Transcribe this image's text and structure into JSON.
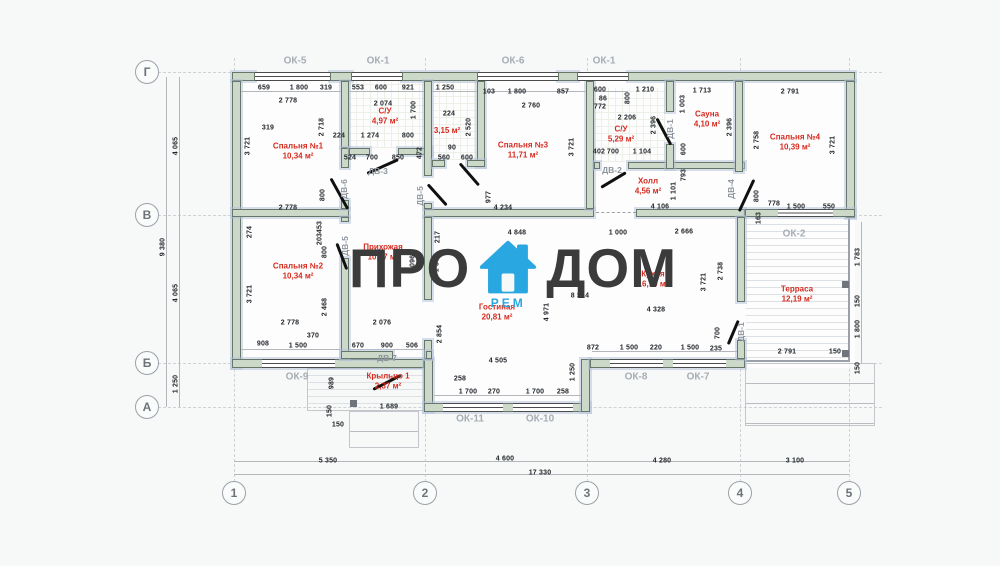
{
  "watermark": {
    "left": "ПРО",
    "right": "ДОМ",
    "badge": "РЕМ",
    "icon": "house-icon",
    "icon_color": "#29a7e0",
    "text_color": "#3b3b3b"
  },
  "axes": {
    "bottom": [
      {
        "label": "1",
        "x": 234
      },
      {
        "label": "2",
        "x": 425
      },
      {
        "label": "3",
        "x": 587
      },
      {
        "label": "4",
        "x": 740
      },
      {
        "label": "5",
        "x": 849
      }
    ],
    "left": [
      {
        "label": "Г",
        "y": 72
      },
      {
        "label": "В",
        "y": 215
      },
      {
        "label": "Б",
        "y": 363
      },
      {
        "label": "А",
        "y": 407
      }
    ]
  },
  "rooms": [
    {
      "name": "Спальня №1",
      "area": "10,34 м²",
      "x": 298,
      "y": 152
    },
    {
      "name": "С/У",
      "area": "4,97 м²",
      "x": 385,
      "y": 117
    },
    {
      "name": "",
      "area": "3,15 м²",
      "x": 447,
      "y": 131
    },
    {
      "name": "Спальня №3",
      "area": "11,71 м²",
      "x": 523,
      "y": 151
    },
    {
      "name": "С/У",
      "area": "5,29 м²",
      "x": 621,
      "y": 135
    },
    {
      "name": "Сауна",
      "area": "4,10 м²",
      "x": 707,
      "y": 120
    },
    {
      "name": "Спальня №4",
      "area": "10,39 м²",
      "x": 795,
      "y": 143
    },
    {
      "name": "Холл",
      "area": "4,56 м²",
      "x": 648,
      "y": 187
    },
    {
      "name": "Спальня №2",
      "area": "10,34 м²",
      "x": 298,
      "y": 272
    },
    {
      "name": "Прихожая",
      "area": "10,57 м²",
      "x": 383,
      "y": 253
    },
    {
      "name": "Гостиная",
      "area": "20,81 м²",
      "x": 497,
      "y": 313
    },
    {
      "name": "Кухня",
      "area": "16,10 м²",
      "x": 653,
      "y": 280
    },
    {
      "name": "Терраса",
      "area": "12,19 м²",
      "x": 797,
      "y": 295
    },
    {
      "name": "Крыльцо 1",
      "area": "2,37 м²",
      "x": 388,
      "y": 382
    }
  ],
  "window_labels": [
    {
      "label": "ОК-5",
      "x": 295,
      "y": 61
    },
    {
      "label": "ОК-1",
      "x": 378,
      "y": 61
    },
    {
      "label": "ОК-6",
      "x": 513,
      "y": 61
    },
    {
      "label": "ОК-1",
      "x": 604,
      "y": 61
    },
    {
      "label": "ОК-2",
      "x": 794,
      "y": 234
    },
    {
      "label": "ОК-9",
      "x": 297,
      "y": 377
    },
    {
      "label": "ОК-11",
      "x": 470,
      "y": 419
    },
    {
      "label": "ОК-10",
      "x": 540,
      "y": 419
    },
    {
      "label": "ОК-8",
      "x": 636,
      "y": 377
    },
    {
      "label": "ОК-7",
      "x": 698,
      "y": 377
    }
  ],
  "door_labels": [
    {
      "label": "ДВ-3",
      "x": 378,
      "y": 171
    },
    {
      "label": "ДВ-6",
      "x": 344,
      "y": 189,
      "v": 1
    },
    {
      "label": "ДВ-5",
      "x": 420,
      "y": 196,
      "v": 1
    },
    {
      "label": "ДВ-2",
      "x": 612,
      "y": 170
    },
    {
      "label": "ДВ-1",
      "x": 670,
      "y": 129,
      "v": 1
    },
    {
      "label": "ДВ-4",
      "x": 731,
      "y": 189,
      "v": 1
    },
    {
      "label": "ДВ-5",
      "x": 345,
      "y": 246,
      "v": 1
    },
    {
      "label": "ДВ-7",
      "x": 387,
      "y": 358
    },
    {
      "label": "ДВ-1",
      "x": 741,
      "y": 332,
      "v": 1
    }
  ],
  "dims": [
    {
      "t": "659",
      "x": 264,
      "y": 88
    },
    {
      "t": "1 800",
      "x": 299,
      "y": 88
    },
    {
      "t": "319",
      "x": 326,
      "y": 88
    },
    {
      "t": "2 778",
      "x": 288,
      "y": 101
    },
    {
      "t": "319",
      "x": 268,
      "y": 128
    },
    {
      "t": "224",
      "x": 339,
      "y": 136
    },
    {
      "t": "1 274",
      "x": 370,
      "y": 136
    },
    {
      "t": "800",
      "x": 408,
      "y": 136
    },
    {
      "t": "524",
      "x": 350,
      "y": 158
    },
    {
      "t": "700",
      "x": 372,
      "y": 158
    },
    {
      "t": "850",
      "x": 398,
      "y": 158
    },
    {
      "t": "553",
      "x": 358,
      "y": 88
    },
    {
      "t": "600",
      "x": 381,
      "y": 88
    },
    {
      "t": "921",
      "x": 408,
      "y": 88
    },
    {
      "t": "2 074",
      "x": 383,
      "y": 104
    },
    {
      "t": "1 250",
      "x": 445,
      "y": 88
    },
    {
      "t": "224",
      "x": 449,
      "y": 114
    },
    {
      "t": "90",
      "x": 452,
      "y": 148
    },
    {
      "t": "560",
      "x": 444,
      "y": 158
    },
    {
      "t": "600",
      "x": 467,
      "y": 158
    },
    {
      "t": "103",
      "x": 489,
      "y": 92
    },
    {
      "t": "1 800",
      "x": 517,
      "y": 92
    },
    {
      "t": "857",
      "x": 563,
      "y": 92
    },
    {
      "t": "2 760",
      "x": 531,
      "y": 106
    },
    {
      "t": "600",
      "x": 600,
      "y": 90
    },
    {
      "t": "86",
      "x": 603,
      "y": 99
    },
    {
      "t": "772",
      "x": 600,
      "y": 107
    },
    {
      "t": "1 210",
      "x": 645,
      "y": 90
    },
    {
      "t": "2 206",
      "x": 627,
      "y": 118
    },
    {
      "t": "402",
      "x": 599,
      "y": 152
    },
    {
      "t": "700",
      "x": 613,
      "y": 152
    },
    {
      "t": "1 104",
      "x": 642,
      "y": 152
    },
    {
      "t": "1 713",
      "x": 702,
      "y": 91
    },
    {
      "t": "2 791",
      "x": 790,
      "y": 92
    },
    {
      "t": "2 778",
      "x": 288,
      "y": 208
    },
    {
      "t": "4 234",
      "x": 503,
      "y": 208
    },
    {
      "t": "4 106",
      "x": 660,
      "y": 207
    },
    {
      "t": "778",
      "x": 774,
      "y": 204
    },
    {
      "t": "1 500",
      "x": 796,
      "y": 207
    },
    {
      "t": "550",
      "x": 829,
      "y": 207
    },
    {
      "t": "4 848",
      "x": 517,
      "y": 233
    },
    {
      "t": "1 000",
      "x": 618,
      "y": 233
    },
    {
      "t": "2 666",
      "x": 684,
      "y": 232
    },
    {
      "t": "8 514",
      "x": 580,
      "y": 296
    },
    {
      "t": "4 328",
      "x": 656,
      "y": 310
    },
    {
      "t": "2 778",
      "x": 290,
      "y": 323
    },
    {
      "t": "2 076",
      "x": 382,
      "y": 323
    },
    {
      "t": "370",
      "x": 313,
      "y": 336
    },
    {
      "t": "908",
      "x": 263,
      "y": 344
    },
    {
      "t": "1 500",
      "x": 298,
      "y": 346
    },
    {
      "t": "670",
      "x": 358,
      "y": 346
    },
    {
      "t": "900",
      "x": 387,
      "y": 346
    },
    {
      "t": "506",
      "x": 412,
      "y": 346
    },
    {
      "t": "872",
      "x": 593,
      "y": 348
    },
    {
      "t": "1 500",
      "x": 629,
      "y": 348
    },
    {
      "t": "220",
      "x": 656,
      "y": 348
    },
    {
      "t": "1 500",
      "x": 690,
      "y": 348
    },
    {
      "t": "235",
      "x": 716,
      "y": 349
    },
    {
      "t": "2 791",
      "x": 787,
      "y": 352
    },
    {
      "t": "150",
      "x": 835,
      "y": 352
    },
    {
      "t": "4 505",
      "x": 498,
      "y": 361
    },
    {
      "t": "258",
      "x": 460,
      "y": 379
    },
    {
      "t": "1 700",
      "x": 468,
      "y": 392
    },
    {
      "t": "270",
      "x": 494,
      "y": 392
    },
    {
      "t": "1 700",
      "x": 535,
      "y": 392
    },
    {
      "t": "258",
      "x": 563,
      "y": 392
    },
    {
      "t": "1 689",
      "x": 389,
      "y": 407
    },
    {
      "t": "150",
      "x": 338,
      "y": 425
    },
    {
      "t": "5 350",
      "x": 328,
      "y": 461
    },
    {
      "t": "4 600",
      "x": 505,
      "y": 459
    },
    {
      "t": "4 280",
      "x": 662,
      "y": 461
    },
    {
      "t": "3 100",
      "x": 795,
      "y": 461
    },
    {
      "t": "17 330",
      "x": 540,
      "y": 473
    },
    {
      "t": "3 721",
      "x": 248,
      "y": 146,
      "v": 1
    },
    {
      "t": "2 718",
      "x": 322,
      "y": 127,
      "v": 1
    },
    {
      "t": "800",
      "x": 323,
      "y": 195,
      "v": 1
    },
    {
      "t": "1 700",
      "x": 414,
      "y": 110,
      "v": 1
    },
    {
      "t": "472",
      "x": 420,
      "y": 153,
      "v": 1
    },
    {
      "t": "2 520",
      "x": 469,
      "y": 127,
      "v": 1
    },
    {
      "t": "3 721",
      "x": 572,
      "y": 147,
      "v": 1
    },
    {
      "t": "977",
      "x": 489,
      "y": 197,
      "v": 1
    },
    {
      "t": "800",
      "x": 628,
      "y": 98,
      "v": 1
    },
    {
      "t": "2 396",
      "x": 654,
      "y": 125,
      "v": 1
    },
    {
      "t": "1 003",
      "x": 683,
      "y": 104,
      "v": 1
    },
    {
      "t": "600",
      "x": 684,
      "y": 149,
      "v": 1
    },
    {
      "t": "793",
      "x": 684,
      "y": 175,
      "v": 1
    },
    {
      "t": "2 396",
      "x": 730,
      "y": 127,
      "v": 1
    },
    {
      "t": "2 758",
      "x": 757,
      "y": 140,
      "v": 1
    },
    {
      "t": "1 101",
      "x": 674,
      "y": 191,
      "v": 1
    },
    {
      "t": "3 721",
      "x": 833,
      "y": 145,
      "v": 1
    },
    {
      "t": "800",
      "x": 757,
      "y": 196,
      "v": 1
    },
    {
      "t": "163",
      "x": 759,
      "y": 218,
      "v": 1
    },
    {
      "t": "274",
      "x": 250,
      "y": 232,
      "v": 1
    },
    {
      "t": "453",
      "x": 320,
      "y": 227,
      "v": 1
    },
    {
      "t": "203",
      "x": 320,
      "y": 239,
      "v": 1
    },
    {
      "t": "800",
      "x": 325,
      "y": 252,
      "v": 1
    },
    {
      "t": "3 721",
      "x": 250,
      "y": 294,
      "v": 1
    },
    {
      "t": "2 468",
      "x": 325,
      "y": 307,
      "v": 1
    },
    {
      "t": "5 096",
      "x": 413,
      "y": 264,
      "v": 1
    },
    {
      "t": "1 500",
      "x": 437,
      "y": 263,
      "v": 1
    },
    {
      "t": "217",
      "x": 438,
      "y": 237,
      "v": 1
    },
    {
      "t": "2 854",
      "x": 440,
      "y": 334,
      "v": 1
    },
    {
      "t": "4 971",
      "x": 547,
      "y": 312,
      "v": 1
    },
    {
      "t": "989",
      "x": 332,
      "y": 383,
      "v": 1
    },
    {
      "t": "150",
      "x": 330,
      "y": 411,
      "v": 1
    },
    {
      "t": "1 250",
      "x": 573,
      "y": 372,
      "v": 1
    },
    {
      "t": "3 721",
      "x": 704,
      "y": 282,
      "v": 1
    },
    {
      "t": "2 738",
      "x": 721,
      "y": 271,
      "v": 1
    },
    {
      "t": "700",
      "x": 718,
      "y": 333,
      "v": 1
    },
    {
      "t": "1 783",
      "x": 858,
      "y": 257,
      "v": 1
    },
    {
      "t": "150",
      "x": 858,
      "y": 301,
      "v": 1
    },
    {
      "t": "1 800",
      "x": 858,
      "y": 329,
      "v": 1
    },
    {
      "t": "150",
      "x": 858,
      "y": 368,
      "v": 1
    },
    {
      "t": "4 065",
      "x": 176,
      "y": 146,
      "v": 1
    },
    {
      "t": "9 380",
      "x": 163,
      "y": 247,
      "v": 1
    },
    {
      "t": "4 065",
      "x": 176,
      "y": 293,
      "v": 1
    },
    {
      "t": "1 250",
      "x": 176,
      "y": 384,
      "v": 1
    }
  ]
}
